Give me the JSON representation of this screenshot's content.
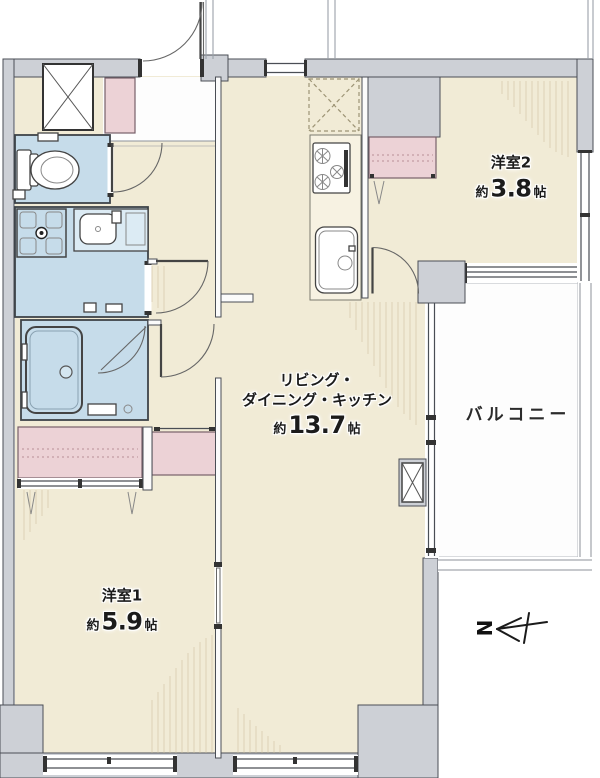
{
  "plan": {
    "rooms": {
      "bedroom2": {
        "name": "洋室2",
        "area_prefix": "約",
        "area_value": "3.8",
        "area_unit": "帖"
      },
      "ldk": {
        "name_line1": "リビング・",
        "name_line2": "ダイニング・キッチン",
        "area_prefix": "約",
        "area_value": "13.7",
        "area_unit": "帖"
      },
      "bedroom1": {
        "name": "洋室1",
        "area_prefix": "約",
        "area_value": "5.9",
        "area_unit": "帖"
      },
      "balcony": {
        "name": "バルコニー"
      }
    },
    "compass": {
      "north_label": "N"
    },
    "colors": {
      "floor": "#f1ebd6",
      "wall": "#cdd0d6",
      "wet_area": "#c6dcea",
      "closet": "#ecd2d6",
      "balcony": "#fdfdfd",
      "outline": "#4a4e55",
      "hatch": "#cdbf9f"
    }
  }
}
